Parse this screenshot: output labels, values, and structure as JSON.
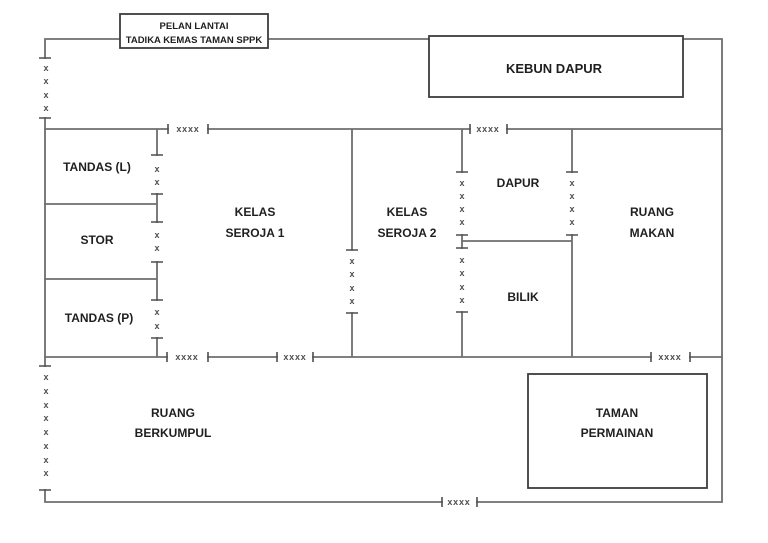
{
  "plan": {
    "title": {
      "line1": "PELAN LANTAI",
      "line2": "TADIKA KEMAS TAMAN SPPK"
    },
    "rooms": {
      "kebun_dapur": {
        "label": "KEBUN DAPUR"
      },
      "tandas_l": {
        "label": "TANDAS (L)"
      },
      "stor": {
        "label": "STOR"
      },
      "tandas_p": {
        "label": "TANDAS (P)"
      },
      "kelas_seroja_1": {
        "line1": "KELAS",
        "line2": "SEROJA 1"
      },
      "kelas_seroja_2": {
        "line1": "KELAS",
        "line2": "SEROJA 2"
      },
      "dapur": {
        "label": "DAPUR"
      },
      "ruang_makan": {
        "line1": "RUANG",
        "line2": "MAKAN"
      },
      "bilik": {
        "label": "BILIK"
      },
      "ruang_berkumpul": {
        "line1": "RUANG",
        "line2": "BERKUMPUL"
      },
      "taman_permainan": {
        "line1": "TAMAN",
        "line2": "PERMAINAN"
      }
    },
    "notation": {
      "door_marker": "xxxx",
      "window_marker": "x"
    },
    "colors": {
      "wall": "#6e6e6e",
      "box_border": "#3c3c3c",
      "label_text": "#1f1f1f",
      "marker": "#4f4f4f",
      "background": "#ffffff"
    }
  }
}
